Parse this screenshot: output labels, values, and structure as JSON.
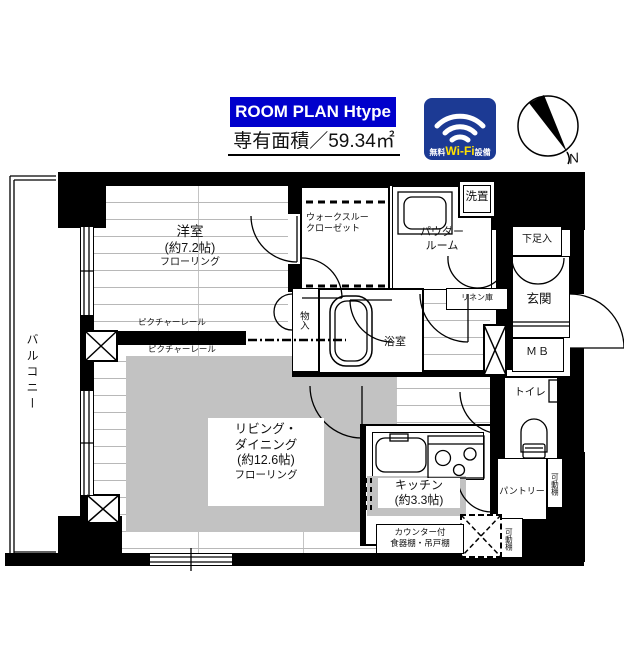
{
  "header": {
    "title": "ROOM PLAN  Htype",
    "area": "専有面積／59.34㎡",
    "wifi_pre": "無料",
    "wifi_brand": "Wi-Fi",
    "wifi_post": "設備",
    "compass_n": "N"
  },
  "colors": {
    "title_blue": "#0000cc",
    "wifi_blue": "#1c3a94",
    "wifi_yellow": "#ffe000",
    "wall_black": "#000000",
    "rug_gray": "#c2c2c2",
    "floor_line": "#b8b8b8"
  },
  "rooms": {
    "balcony": "バルコニー",
    "western1": "洋室",
    "western2": "(約7.2帖)",
    "western3": "フローリング",
    "wtc1": "ウォークスルー",
    "wtc2": "クローゼット",
    "powder1": "パウダー",
    "powder2": "ルーム",
    "laundry": "洗置",
    "linen": "リネン庫",
    "shoe": "下足入",
    "entrance": "玄関",
    "mb": "ＭＢ",
    "toilet": "トイレ",
    "bath": "浴室",
    "storage": "物入",
    "ld1": "リビング・",
    "ld2": "ダイニング",
    "ld3": "(約12.6帖)",
    "ld4": "フローリング",
    "kitchen1": "キッチン",
    "kitchen2": "(約3.3帖)",
    "pantry": "パントリー",
    "shelf1": "可動棚",
    "shelf2": "可動棚",
    "counter1": "カウンター付",
    "counter2": "食器棚・吊戸棚",
    "rail1": "ピクチャーレール",
    "rail2": "ピクチャーレール"
  }
}
